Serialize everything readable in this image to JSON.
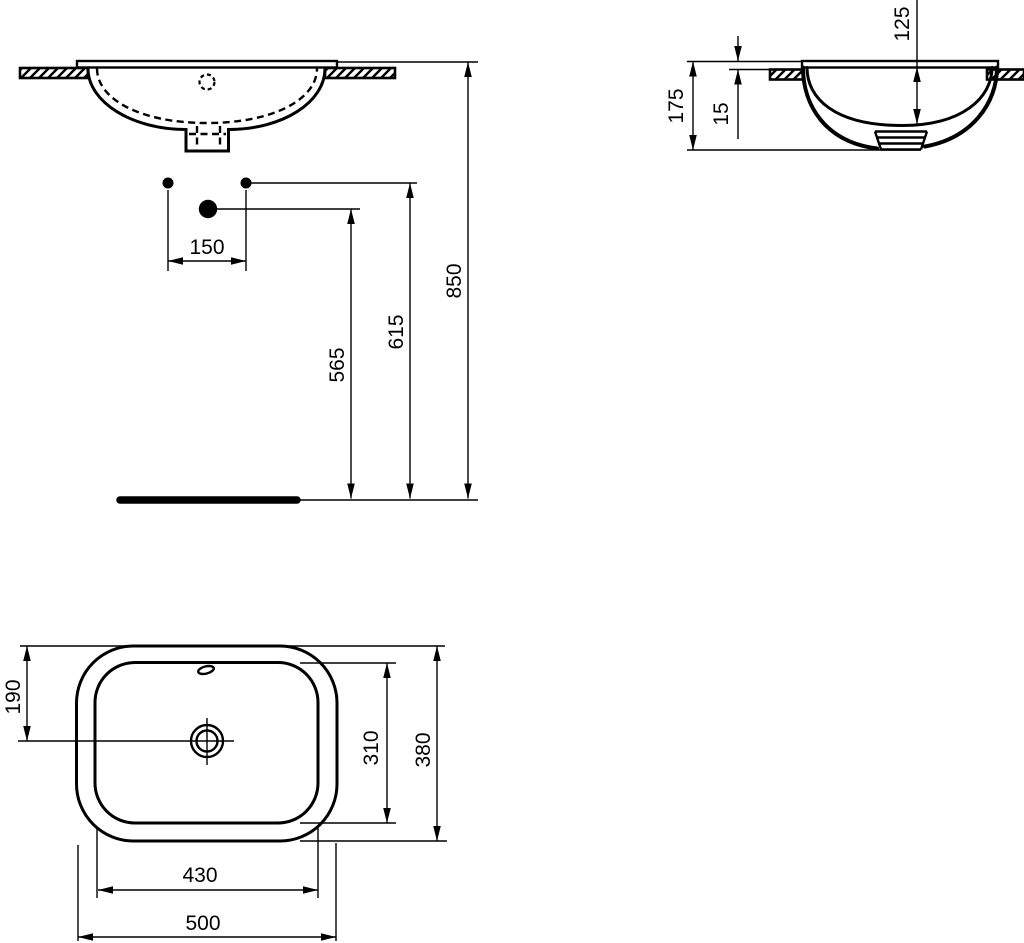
{
  "drawing": {
    "colors": {
      "ink": "#000000",
      "paper": "#ffffff"
    },
    "front_view": {
      "dims": {
        "tap_hole_spacing": "150",
        "waste_outlet_height": "565",
        "tap_hole_height": "615",
        "rim_height": "850"
      }
    },
    "side_view": {
      "dims": {
        "depth_below_counter": "175",
        "rim_above_counter": "15",
        "bowl_depth": "125"
      }
    },
    "plan_view": {
      "dims": {
        "front_edge_to_waste": "190",
        "bowl_inner_depth": "310",
        "overall_depth": "380",
        "bowl_inner_width": "430",
        "overall_width": "500"
      }
    }
  }
}
